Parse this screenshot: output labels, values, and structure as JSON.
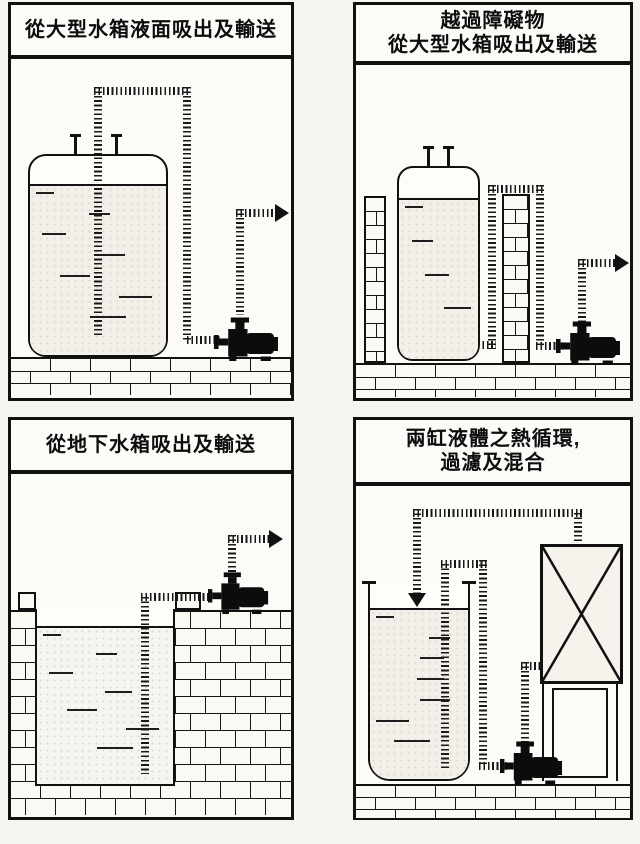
{
  "page": {
    "background": "#f6f5f0",
    "ink": "#111111",
    "paper": "#fcfbf8",
    "liquid_tint": "#f2f0e9"
  },
  "icons": {
    "flow_arrow_right": "▶",
    "flow_arrow_down": "▼",
    "pump": "pump-silhouette",
    "filter": "box-with-x"
  },
  "panels": [
    {
      "title": "從大型水箱液面吸出及輸送"
    },
    {
      "title": "越過障礙物\n從大型水箱吸出及輸送"
    },
    {
      "title": "從地下水箱吸出及輸送"
    },
    {
      "title": "兩缸液體之熱循環,\n過濾及混合"
    }
  ]
}
